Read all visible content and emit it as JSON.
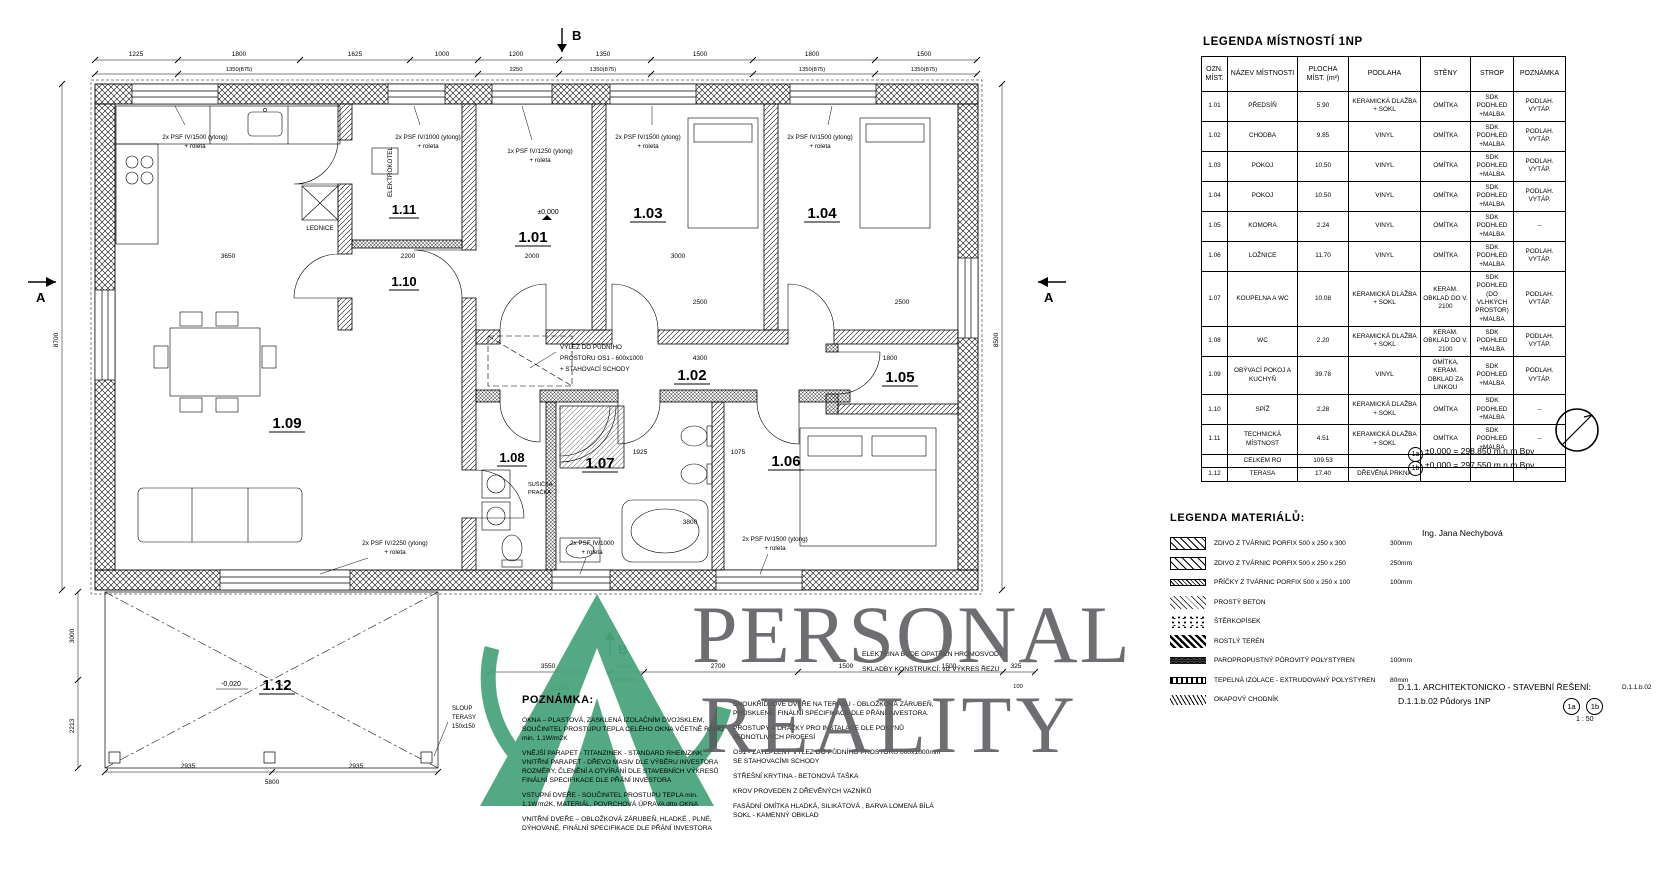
{
  "legend_rooms": {
    "title": "LEGENDA MÍSTNOSTÍ 1NP",
    "headers": [
      "OZN. MÍST.",
      "NÁZEV MÍSTNOSTI",
      "PLOCHA MÍST. (m²)",
      "PODLAHA",
      "STĚNY",
      "STROP",
      "POZNÁMKA"
    ],
    "rows": [
      [
        "1.01",
        "PŘEDSÍŇ",
        "5.90",
        "KERAMICKÁ DLAŽBA + SOKL",
        "OMÍTKA",
        "SDK PODHLED +MALBA",
        "PODLAH. VYTÁP."
      ],
      [
        "1.02",
        "CHODBA",
        "9.85",
        "VINYL",
        "OMÍTKA",
        "SDK PODHLED +MALBA",
        "PODLAH. VYTÁP."
      ],
      [
        "1.03",
        "POKOJ",
        "10.50",
        "VINYL",
        "OMÍTKA",
        "SDK PODHLED +MALBA",
        "PODLAH. VYTÁP."
      ],
      [
        "1.04",
        "POKOJ",
        "10.50",
        "VINYL",
        "OMÍTKA",
        "SDK PODHLED +MALBA",
        "PODLAH. VYTÁP."
      ],
      [
        "1.05",
        "KOMORA",
        "2.24",
        "VINYL",
        "OMÍTKA",
        "SDK PODHLED +MALBA",
        "–"
      ],
      [
        "1.06",
        "LOŽNICE",
        "11.70",
        "VINYL",
        "OMÍTKA",
        "SDK PODHLED +MALBA",
        "PODLAH. VYTÁP."
      ],
      [
        "1.07",
        "KOUPELNA A WC",
        "10.08",
        "KERAMICKÁ DLAŽBA + SOKL",
        "KERAM. OBKLAD DO V. 2100",
        "SDK PODHLED (DO VLHKÝCH PROSTOR) +MALBA",
        "PODLAH. VYTÁP."
      ],
      [
        "1.08",
        "WC",
        "2.20",
        "KERAMICKÁ DLAŽBA + SOKL",
        "KERAM. OBKLAD DO V. 2100",
        "SDK PODHLED +MALBA",
        "PODLAH. VYTÁP."
      ],
      [
        "1.09",
        "OBÝVACÍ POKOJ A KUCHYŇ",
        "39.78",
        "VINYL",
        "OMÍTKA, KERAM. OBKLAD ZA LINKOU",
        "SDK PODHLED +MALBA",
        "PODLAH. VYTÁP."
      ],
      [
        "1.10",
        "SPÍŽ",
        "2.28",
        "KERAMICKÁ DLAŽBA + SOKL",
        "OMÍTKA",
        "SDK PODHLED +MALBA",
        "–"
      ],
      [
        "1.11",
        "TECHNICKÁ MÍSTNOST",
        "4.51",
        "KERAMICKÁ DLAŽBA + SOKL",
        "OMÍTKA",
        "SDK PODHLED +MALBA",
        "–"
      ],
      [
        "",
        "CELKEM RO",
        "109.53",
        "",
        "",
        "",
        ""
      ],
      [
        "1.12",
        "TERASA",
        "17.40",
        "DŘEVĚNÁ PRKNA",
        "",
        "",
        ""
      ]
    ]
  },
  "elevations": {
    "a_badge": "1a",
    "a_text": "±0,000 = 298,850  m.n.m  Bpv",
    "b_badge": "1b",
    "b_text": "±0,000 = 297,550  m.n.m  Bpv"
  },
  "legend_materials": {
    "title": "LEGENDA MATERIÁLŮ:",
    "items": [
      {
        "label": "ZDIVO Z TVÁRNIC PORFIX 500 x 250 x 300",
        "thickness": "300mm",
        "swatch": "sw-diag"
      },
      {
        "label": "ZDIVO Z TVÁRNIC PORFIX 500 x 250 x 250",
        "thickness": "250mm",
        "swatch": "sw-cross"
      },
      {
        "label": "PŘÍČKY Z TVÁRNIC PORFIX 500 x 250 x 100",
        "thickness": "100mm",
        "swatch": "sw-strip"
      },
      {
        "label": "PROSTÝ BETON",
        "thickness": "",
        "swatch": "sw-beton"
      },
      {
        "label": "ŠTĚRKOPÍSEK",
        "thickness": "",
        "swatch": "sw-sterk"
      },
      {
        "label": "ROSTLÝ TERÉN",
        "thickness": "",
        "swatch": "sw-teren"
      },
      {
        "label": "PAROPROPUSTNÝ PÓROVITÝ POLYSTYREN",
        "thickness": "100mm",
        "swatch": "sw-poly"
      },
      {
        "label": "TEPELNÁ IZOLACE - EXTRUDOVANÝ POLYSTYREN",
        "thickness": "80mm",
        "swatch": "sw-xps"
      },
      {
        "label": "OKAPOVÝ CHODNÍK",
        "thickness": "",
        "swatch": "sw-okap"
      }
    ]
  },
  "author": "Ing. Jana Nechybová",
  "titleblock": {
    "line1": "D.1.1. ARCHITEKTONICKO - STAVEBNÍ ŘEŠENÍ:",
    "line2": "D.1.1.b.02 Půdorys 1NP",
    "badge_a": "1a",
    "badge_b": "1b",
    "scale": "1 : 50",
    "doc": "D.1.1.b.02"
  },
  "notes": {
    "title": "POZNÁMKA:",
    "col1": [
      "OKNA – PLASTOVÁ, ZASKLENÁ IZOLAČNÍM DVOJSKLEM, SOUČINITEL PROSTUPU TEPLA CELÉHO OKNA VČETNĚ RÁMU min. 1,1W/m2K",
      "VNĚJŠÍ PARAPET - TITANZINEK - STANDARD RHEINZINK VNITŘNÍ PARAPET - DŘEVO MASIV DLE VÝBĚRU INVESTORA ROZMĚRY, ČLENĚNÍ A OTVÍRÁNÍ DLE STAVEBNÍCH VÝKRESŮ FINÁLNÍ SPECIFIKACE DLE PŘÁNÍ INVESTORA",
      "VSTUPNÍ DVEŘE - SOUČINITEL PROSTUPU TEPLA min. 1,1W/m2K, MATERIÁL, POVRCHOVÁ ÚPRAVA dtto OKNA",
      "VNITŘNÍ DVEŘE – OBLOŽKOVÁ ZÁRUBEŇ, HLADKÉ , PLNÉ, DÝHOVANÉ, FINÁLNÍ SPECIFIKACE DLE PŘÁNÍ INVESTORA"
    ],
    "col2": [
      "DVOUKŘÍDLOVÉ DVEŘE NA TERASU - OBLOŽKOVÁ ZÁRUBEŇ, PROSKLENÉ, FINÁLNÍ SPECIFIKACE DLE PŘÁNÍ INVESTORA.",
      "PROSTUPY A DRÁŽKY PRO INSTALACE DLE POKYNŮ JEDNOTLIVÝCH PROFESÍ",
      "OS1 - ZATEPLENÝ VÝLEZ DO PŮDNÍHO PROSTORU 600x1000mm SE STAHOVACÍMI SCHODY",
      "STŘEŠNÍ KRYTINA - BETONOVÁ TAŠKA",
      "KROV PROVEDEN Z DŘEVĚNÝCH VAZNÍKŮ",
      "FASÁDNÍ OMÍTKA HLADKÁ, SILIKÁTOVÁ , BARVA LOMENÁ BÍLÁ SOKL - KAMENNÝ OBKLAD"
    ],
    "col3": [
      "ELEKTŘINA BUDE OPATŘEN HROMOSVODY",
      "SKLADBY KONSTRUKCÍ: viz VÝKRES ŘEZU"
    ]
  },
  "watermark": {
    "line1": "PERSONAL",
    "line2": "REALITY",
    "green": "#49a57d",
    "gray": "#5a5b5e"
  },
  "plan": {
    "rooms": [
      "1.01",
      "1.02",
      "1.03",
      "1.04",
      "1.05",
      "1.06",
      "1.07",
      "1.08",
      "1.09",
      "1.10",
      "1.11",
      "1.12"
    ],
    "sections": {
      "a": "A",
      "b": "B"
    },
    "levels": {
      "zero": "±0,000",
      "terrace": "-0,020"
    },
    "ann": {
      "win_1500": "2x PSF IV/1500 (ytong)",
      "win_1000": "2x PSF IV/1000 (ytong)",
      "win_1250": "1x PSF IV/1250 (ytong)",
      "win_2250": "2x PSF IV/2250 (ytong)",
      "win_1000s": "2x PSF IV/1000",
      "roleta": "+ roleta",
      "elektrokotel": "ELEKTROKOTEL",
      "lednice": "LEDNICE",
      "susicka": "SUŠIČKA",
      "pracka": "PRAČKA",
      "vylez1": "VÝLEZ DO PŮDNÍHO",
      "vylez2": "PROSTORU OS1 - 600x1000",
      "vylez3": "+ STAHOVACÍ SCHODY",
      "sloup1": "SLOUP",
      "sloup2": "TERASY",
      "sloup3": "150x150"
    },
    "dims_top": [
      "1225",
      "1800",
      "1625",
      "1000",
      "1200",
      "1350",
      "1500",
      "1800",
      "1500"
    ],
    "dims_top2": [
      "1350(875)",
      "2250",
      "1350(875)",
      "1350(875)",
      "1350(875)"
    ],
    "dims_bottom": [
      "3550",
      "1000",
      "2700",
      "1500",
      "1500",
      "325"
    ],
    "dims_bottom2": [
      "1350(875)",
      "15200",
      "100"
    ],
    "dims_left": [
      "8700"
    ],
    "dims_right": [
      "8500"
    ],
    "dims_terrace": [
      "3000",
      "2213",
      "2935",
      "5800",
      "2935"
    ],
    "dims_inner": [
      "3650",
      "2200",
      "2000",
      "3000",
      "2500",
      "2500",
      "4300",
      "1800",
      "1925",
      "1075",
      "3800"
    ]
  }
}
